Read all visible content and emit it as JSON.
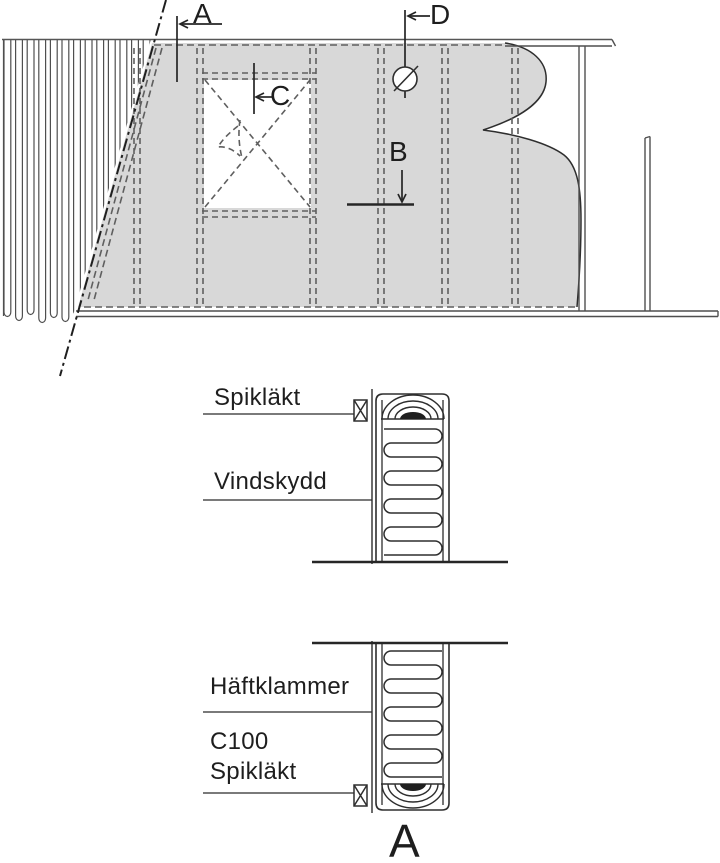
{
  "drawing": {
    "labels": {
      "a": "A",
      "b": "B",
      "c": "C",
      "d": "D"
    },
    "annotations": {
      "spiklakt_top": "Spikläkt",
      "vindskydd": "Vindskydd",
      "haftklammer": "Häftklammer",
      "c100": "C100",
      "spiklakt_bottom": "Spikläkt"
    },
    "section_marker": "A",
    "colors": {
      "membrane_fill": "#d8d8d8",
      "line": "#2e2e2e",
      "dashed_line": "#5f5f5f"
    }
  }
}
